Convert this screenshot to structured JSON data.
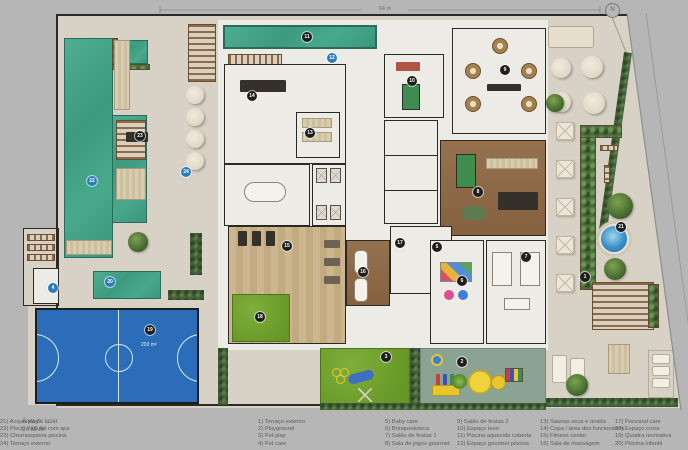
{
  "title": {
    "area_label": "Área de lazer",
    "area_value": "2.765 m²"
  },
  "plan": {
    "top_dimension": "64 m",
    "north_label": "N",
    "court_area_label": "203 m²"
  },
  "legend": {
    "columns": [
      [
        {
          "n": "1",
          "label": "Terraço externo"
        },
        {
          "n": "2",
          "label": "Playground"
        },
        {
          "n": "3",
          "label": "Pet play"
        },
        {
          "n": "4",
          "label": "Pet care"
        }
      ],
      [
        {
          "n": "5",
          "label": "Baby care"
        },
        {
          "n": "6",
          "label": "Brinquedoteca"
        },
        {
          "n": "7",
          "label": "Salão de festas 1"
        },
        {
          "n": "8",
          "label": "Sala de jogos gourmet"
        }
      ],
      [
        {
          "n": "9",
          "label": "Salão de festas 2"
        },
        {
          "n": "10",
          "label": "Espaço teen"
        },
        {
          "n": "11",
          "label": "Piscina aquecida coberta"
        },
        {
          "n": "12",
          "label": "Espaço gourmet piscina"
        }
      ],
      [
        {
          "n": "13",
          "label": "Saunas seca e úmida"
        },
        {
          "n": "14",
          "label": "Copa / área dos funcionários"
        },
        {
          "n": "15",
          "label": "Fitness center"
        },
        {
          "n": "16",
          "label": "Sala de massagem"
        }
      ],
      [
        {
          "n": "17",
          "label": "Personal care"
        },
        {
          "n": "18",
          "label": "Espaço cross"
        },
        {
          "n": "19",
          "label": "Quadra recreativa"
        },
        {
          "n": "20",
          "label": "Piscina infantil"
        }
      ],
      [
        {
          "n": "21",
          "label": "Acqua play"
        },
        {
          "n": "22",
          "label": "Piscina adulto com spa"
        },
        {
          "n": "23",
          "label": "Churrasqueira piscina"
        },
        {
          "n": "24",
          "label": "Terraço externo"
        }
      ]
    ]
  },
  "markers": [
    {
      "n": "1",
      "x": 585,
      "y": 277,
      "c": "dark"
    },
    {
      "n": "2",
      "x": 462,
      "y": 362,
      "c": "dark"
    },
    {
      "n": "3",
      "x": 386,
      "y": 357,
      "c": "dark"
    },
    {
      "n": "4",
      "x": 53,
      "y": 288,
      "c": "blue"
    },
    {
      "n": "5",
      "x": 437,
      "y": 247,
      "c": "dark"
    },
    {
      "n": "6",
      "x": 462,
      "y": 281,
      "c": "dark"
    },
    {
      "n": "7",
      "x": 526,
      "y": 257,
      "c": "dark"
    },
    {
      "n": "8",
      "x": 478,
      "y": 192,
      "c": "dark"
    },
    {
      "n": "9",
      "x": 505,
      "y": 70,
      "c": "dark"
    },
    {
      "n": "10",
      "x": 412,
      "y": 81,
      "c": "dark"
    },
    {
      "n": "11",
      "x": 307,
      "y": 37,
      "c": "dark"
    },
    {
      "n": "12",
      "x": 332,
      "y": 58,
      "c": "blue"
    },
    {
      "n": "13",
      "x": 310,
      "y": 133,
      "c": "dark"
    },
    {
      "n": "14",
      "x": 252,
      "y": 96,
      "c": "dark"
    },
    {
      "n": "15",
      "x": 287,
      "y": 246,
      "c": "dark"
    },
    {
      "n": "16",
      "x": 363,
      "y": 272,
      "c": "dark"
    },
    {
      "n": "17",
      "x": 400,
      "y": 243,
      "c": "dark"
    },
    {
      "n": "18",
      "x": 260,
      "y": 317,
      "c": "dark"
    },
    {
      "n": "19",
      "x": 150,
      "y": 330,
      "c": "dark"
    },
    {
      "n": "20",
      "x": 110,
      "y": 282,
      "c": "blue"
    },
    {
      "n": "21",
      "x": 621,
      "y": 227,
      "c": "dark"
    },
    {
      "n": "22",
      "x": 92,
      "y": 181,
      "c": "blue"
    },
    {
      "n": "23",
      "x": 140,
      "y": 136,
      "c": "dark"
    },
    {
      "n": "24",
      "x": 186,
      "y": 172,
      "c": "blue"
    }
  ],
  "colors": {
    "bg": "#b6b6b6",
    "deck": "#d8d1c5",
    "interior": "#edebe6",
    "wall": "#2a2923",
    "pool-edge": "#2c6b59",
    "court": "#2b6db8",
    "court-line": "#d6e7f6",
    "sage": "#8ba393",
    "hedge": "#43603a",
    "marker-dark": "#1e1e1c",
    "marker-blue": "#2b7cbe"
  }
}
